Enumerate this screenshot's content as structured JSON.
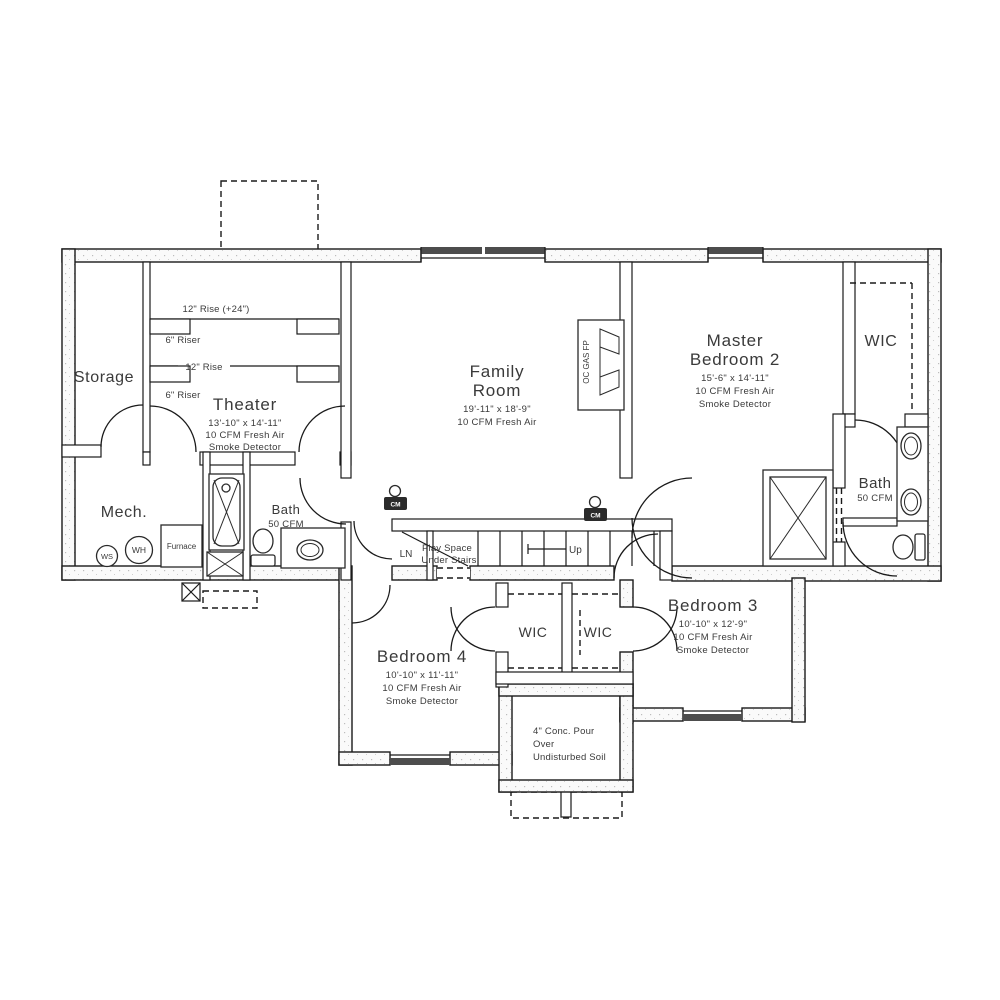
{
  "rooms": {
    "storage": {
      "name": "Storage"
    },
    "theater": {
      "name": "Theater",
      "dims": "13'-10\" x 14'-11\"",
      "fresh_air": "10 CFM Fresh Air",
      "smoke": "Smoke Detector"
    },
    "family": {
      "name1": "Family",
      "name2": "Room",
      "dims": "19'-11\" x 18'-9\"",
      "fresh_air": "10 CFM Fresh Air"
    },
    "master": {
      "name1": "Master",
      "name2": "Bedroom 2",
      "dims": "15'-6\" x 14'-11\"",
      "fresh_air": "10 CFM Fresh Air",
      "smoke": "Smoke Detector"
    },
    "master_wic": {
      "name": "WIC"
    },
    "master_bath": {
      "name": "Bath",
      "fan": "50 CFM"
    },
    "mech": {
      "name": "Mech.",
      "ws": "WS",
      "wh": "WH",
      "furnace": "Furnace"
    },
    "main_bath": {
      "name": "Bath",
      "fan": "50 CFM"
    },
    "linen": {
      "name": "LN"
    },
    "stairs": {
      "note1": "Play Space",
      "note2": "Under Stairs",
      "up": "Up"
    },
    "bedroom3": {
      "name": "Bedroom 3",
      "dims": "10'-10\" x 12'-9\"",
      "fresh_air": "10 CFM Fresh Air",
      "smoke": "Smoke Detector"
    },
    "bedroom4": {
      "name": "Bedroom 4",
      "dims": "10'-10\" x 11'-11\"",
      "fresh_air": "10 CFM Fresh Air",
      "smoke": "Smoke Detector"
    },
    "wic_b4": {
      "name": "WIC"
    },
    "wic_b3": {
      "name": "WIC"
    },
    "concrete": {
      "line1": "4\" Conc. Pour",
      "line2": "Over",
      "line3": "Undisturbed Soil"
    }
  },
  "theater_risers": {
    "rise_back": "12\" Rise (+24\")",
    "riser_back": "6\" Riser",
    "rise_front": "12\" Rise",
    "riser_front": "6\" Riser"
  },
  "fireplace": {
    "label": "OC GAS FP"
  },
  "detectors": {
    "cm1": "CM",
    "cm2": "CM"
  },
  "colors": {
    "wall": "#1a1a1a",
    "text": "#3a3a3a",
    "window_band": "#4d4d4d"
  }
}
